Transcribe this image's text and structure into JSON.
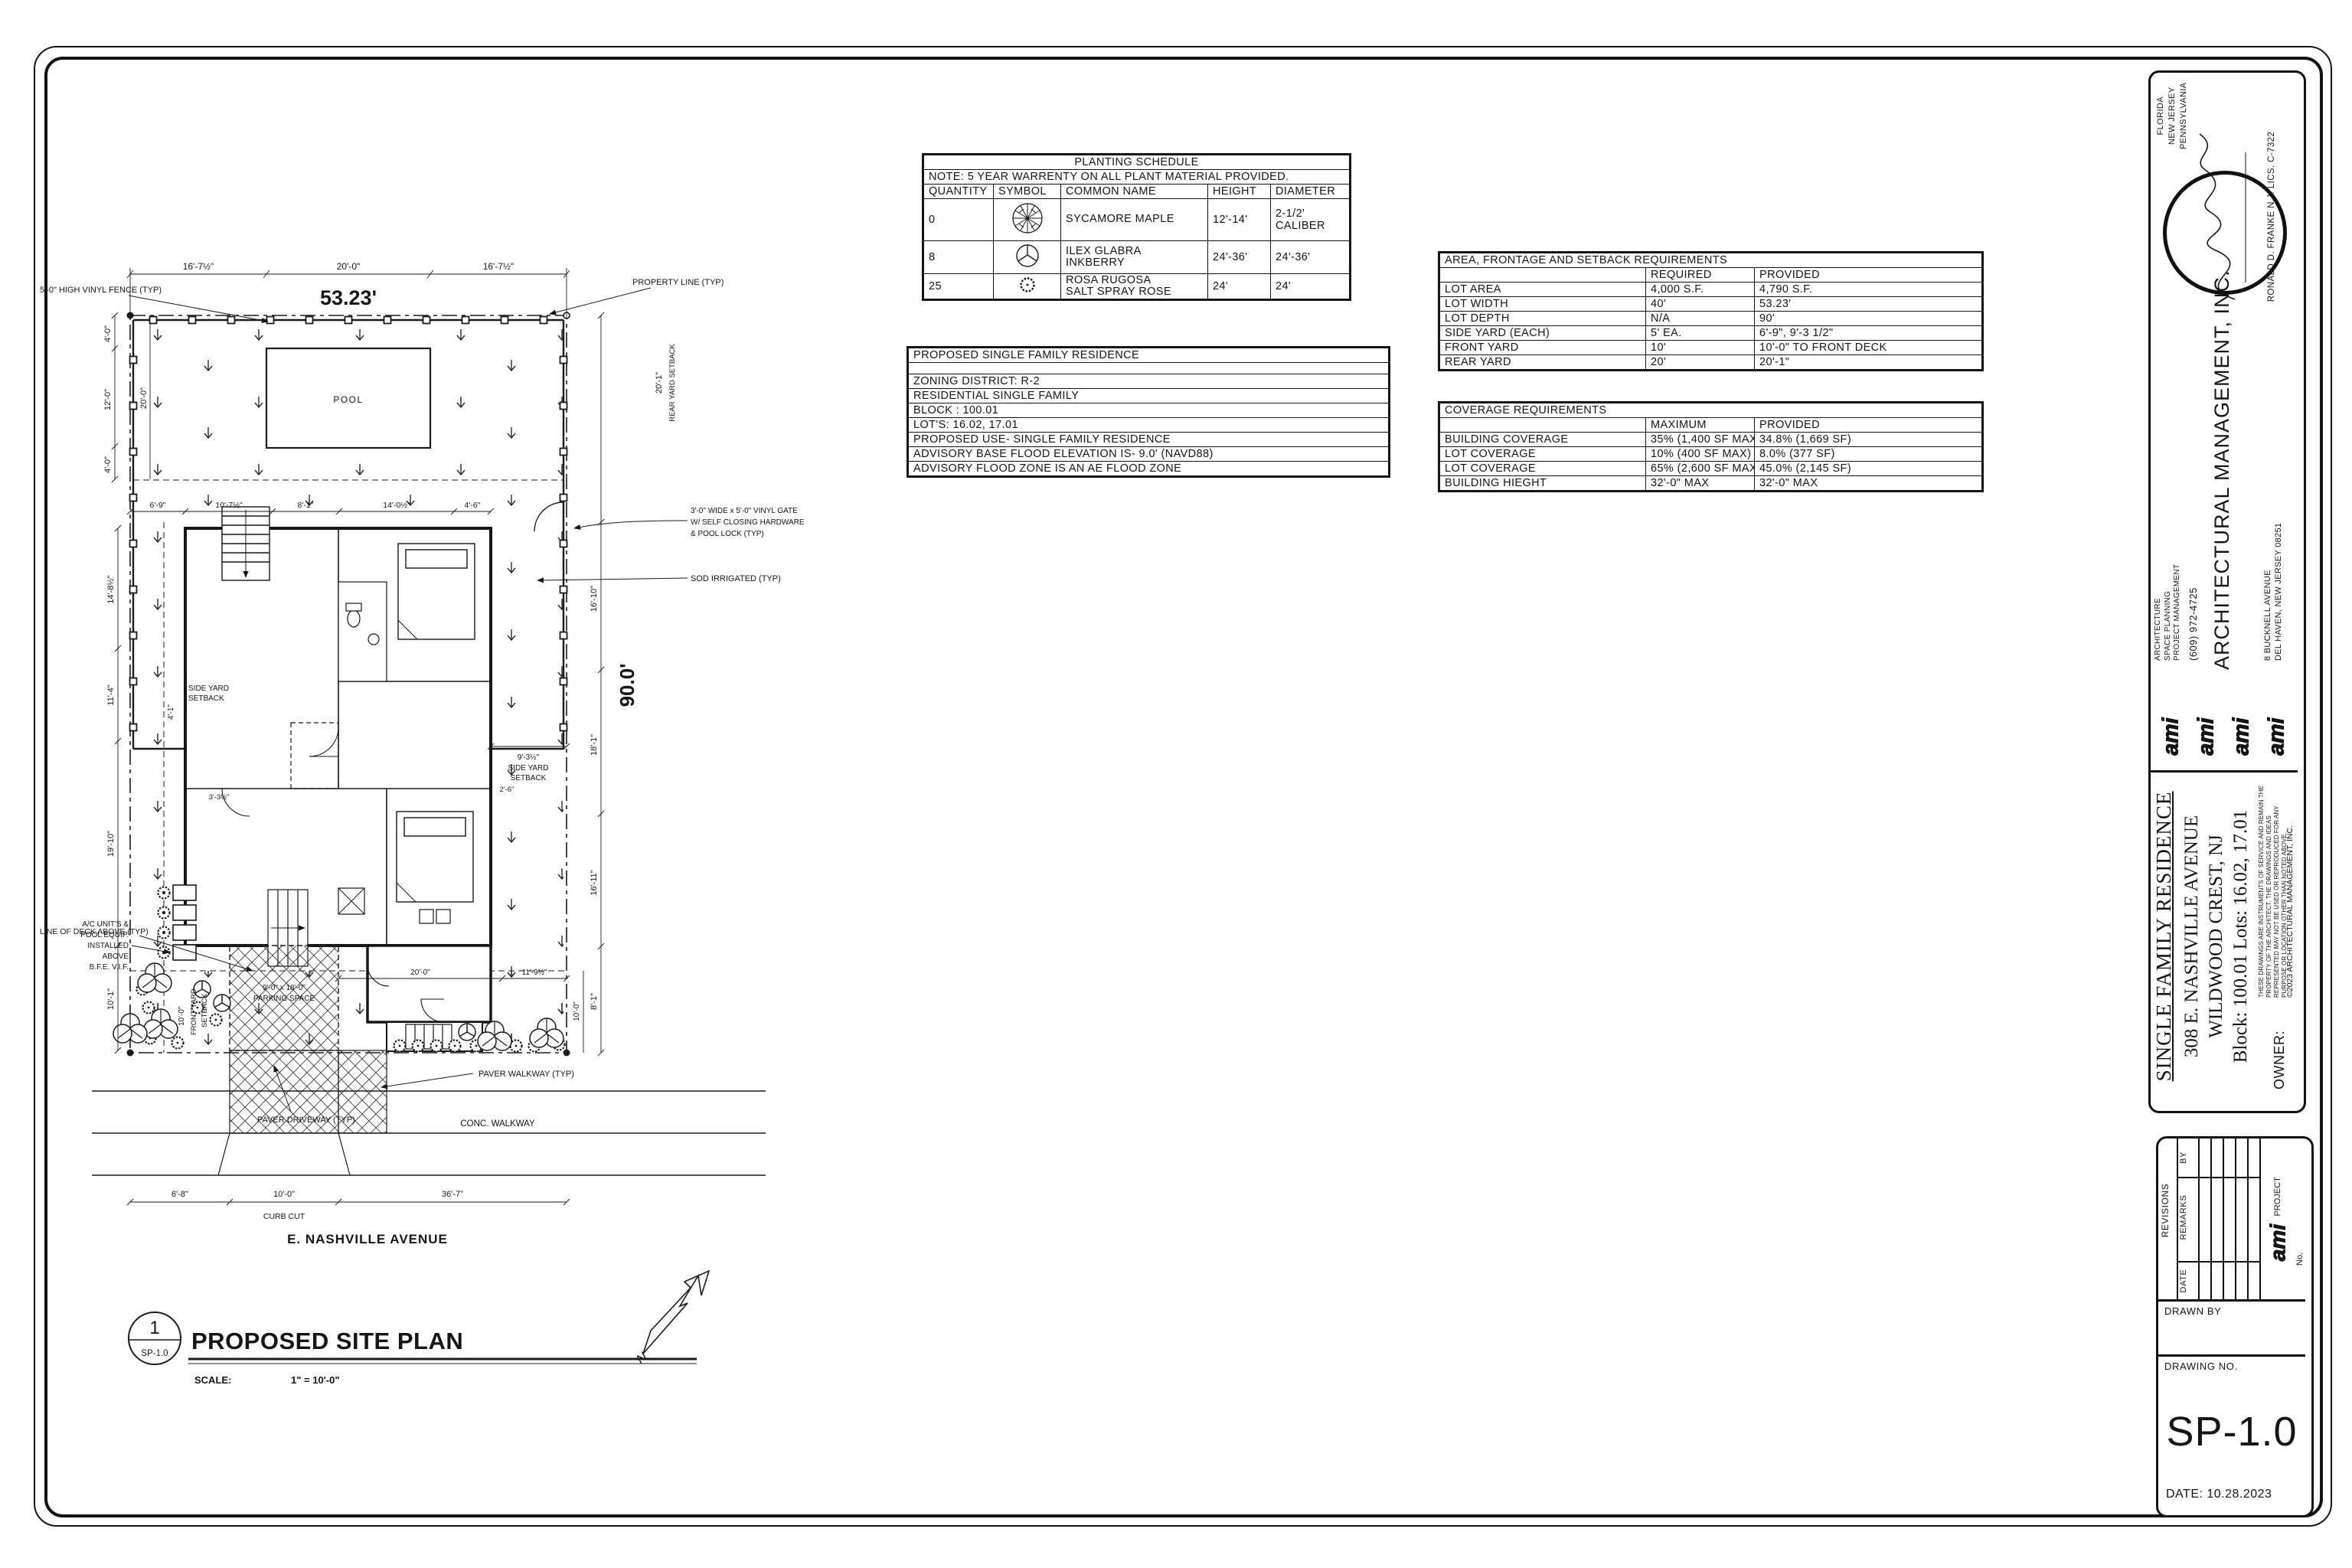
{
  "sheet_id": "SP-1.0",
  "planting_schedule": {
    "title": "PLANTING SCHEDULE",
    "note": "NOTE: 5 YEAR WARRENTY ON ALL PLANT MATERIAL PROVIDED.",
    "headers": [
      "QUANTITY",
      "SYMBOL",
      "COMMON NAME",
      "HEIGHT",
      "DIAMETER"
    ],
    "rows": [
      {
        "quantity": "0",
        "symbol": "sycamore-maple-symbol",
        "name": [
          "SYCAMORE MAPLE",
          ""
        ],
        "height": "12'-14'",
        "diameter": "2-1/2' CALIBER"
      },
      {
        "quantity": "8",
        "symbol": "inkberry-symbol",
        "name": [
          "ILEX GLABRA",
          "INKBERRY"
        ],
        "height": "24'-36'",
        "diameter": "24'-36'"
      },
      {
        "quantity": "25",
        "symbol": "salt-spray-rose-symbol",
        "name": [
          "ROSA RUGOSA",
          "SALT SPRAY ROSE"
        ],
        "height": "24'",
        "diameter": "24'"
      }
    ]
  },
  "residence_table": {
    "title": "PROPOSED SINGLE FAMILY RESIDENCE",
    "rows": [
      "ZONING DISTRICT: R-2",
      "RESIDENTIAL SINGLE FAMILY",
      "BLOCK : 100.01",
      "LOT'S: 16.02, 17.01",
      "PROPOSED USE- SINGLE FAMILY RESIDENCE",
      "ADVISORY BASE FLOOD ELEVATION IS- 9.0' (NAVD88)",
      "ADVISORY FLOOD ZONE IS AN AE FLOOD ZONE"
    ]
  },
  "area_table": {
    "title": "AREA, FRONTAGE AND SETBACK REQUIREMENTS",
    "col_required": "REQUIRED",
    "col_provided": "PROVIDED",
    "rows": [
      {
        "label": "LOT AREA",
        "required": "4,000 S.F.",
        "provided": "4,790 S.F."
      },
      {
        "label": "LOT WIDTH",
        "required": "40'",
        "provided": "53.23'"
      },
      {
        "label": "LOT DEPTH",
        "required": "N/A",
        "provided": "90'"
      },
      {
        "label": "SIDE YARD (EACH)",
        "required": "5' EA.",
        "provided": "6'-9\", 9'-3 1/2\""
      },
      {
        "label": "FRONT YARD",
        "required": "10'",
        "provided": "10'-0\" TO FRONT DECK"
      },
      {
        "label": "REAR YARD",
        "required": "20'",
        "provided": "20'-1\""
      }
    ]
  },
  "coverage_table": {
    "title": "COVERAGE REQUIREMENTS",
    "col_max": "MAXIMUM",
    "col_provided": "PROVIDED",
    "rows": [
      {
        "label": "BUILDING COVERAGE",
        "max": "35%  (1,400 SF MAX)",
        "provided": "34.8%  (1,669 SF)"
      },
      {
        "label": "LOT COVERAGE",
        "max": "10%  (400 SF MAX)",
        "provided": "8.0%  (377 SF)"
      },
      {
        "label": "LOT COVERAGE",
        "max": "65%  (2,600 SF MAX)",
        "provided": "45.0%  (2,145 SF)"
      },
      {
        "label": "BUILDING HIEGHT",
        "max": "32'-0\" MAX",
        "provided": "32'-0\" MAX"
      }
    ]
  },
  "site_plan": {
    "labels": {
      "fence": "5'-0\" HIGH VINYL FENCE (TYP)",
      "property": "PROPERTY LINE (TYP)",
      "gate1": "3'-0\" WIDE x 5'-0\" VINYL GATE",
      "gate2": "W/ SELF CLOSING HARDWARE",
      "gate3": "& POOL LOCK (TYP)",
      "sod": "SOD IRRIGATED (TYP)",
      "ac1": "A/C UNIT'S &",
      "ac2": "POOL EQUIP.",
      "ac3": "INSTALLED",
      "ac4": "ABOVE",
      "ac5": "B.F.E. V.I.F.",
      "deck": "LINE OF DECK ABOVE (TYP)",
      "park1": "9'-0\" x 18'-0\"",
      "park2": "PARKING SPACE",
      "drive": "PAVER DRIVEWAY (TYP)",
      "walk": "PAVER WALKWAY (TYP)",
      "conc": "CONC. WALKWAY",
      "street": "E. NASHVILLE AVENUE",
      "pool": "POOL"
    },
    "dims": {
      "top1": "16'-7½\"",
      "top2": "20'-0\"",
      "top3": "16'-7½\"",
      "lot_width": "53.23'",
      "left4a": "4'-0\"",
      "left12": "12'-0\"",
      "left4b": "4'-0\"",
      "left20": "20'-0\"",
      "row2_1": "6'-9\"",
      "row2_2": "10'-7½\"",
      "row2_3": "8'-1\"",
      "row2_4": "14'-0½\"",
      "row2_5": "4'-6\"",
      "v14": "14'-8½\"",
      "v11": "11'-4\"",
      "v3": "3'-3½\"",
      "v19": "19'-10\"",
      "v10": "10'-1\"",
      "r16": "16'-10\"",
      "r18": "18'-1\"",
      "r16b": "16'-11\"",
      "r8": "8'-1\"",
      "r10": "10'-0\"",
      "depth": "90.0'",
      "rear": "20'-1\"",
      "rear_label": "REAR YARD SETBACK",
      "sideL": "4'-1\"",
      "side_label1": "SIDE YARD",
      "side_label2": "SETBACK",
      "sideR": "9'-3½\"",
      "front_label1": "FRONT YARD",
      "front_label2": "SETBACK",
      "front10": "10'-0\"",
      "f20": "20'-0\"",
      "f11": "11'-9½\"",
      "b1": "6'-8\"",
      "b2": "10'-0\"",
      "b3": "36'-7\"",
      "curb": "CURB CUT",
      "c26": "2'-6\""
    },
    "title_bar": {
      "num": "1",
      "sheet": "SP-1.0",
      "name": "PROPOSED SITE PLAN",
      "scale_label": "SCALE:",
      "scale_value": "1\" = 10'-0\"",
      "north": "N"
    }
  },
  "titleblock": {
    "states": [
      "FLORIDA",
      "NEW JERSEY",
      "PENNSYLVANIA"
    ],
    "license": "RONALD D. FRANKE N.J. LICS. C-7322",
    "services": [
      "ARCHITECTURE",
      "SPACE PLANNING",
      "PROJECT MANAGEMENT"
    ],
    "phone": "(609) 972-4725",
    "firm": "ARCHITECTURAL MANAGEMENT, INC.",
    "address1": "8 BUCKNELL AVENUE",
    "address2": "DEL HAVEN, NEW JERSEY 08251",
    "logo": "ami",
    "project_title": "SINGLE FAMILY RESIDENCE",
    "project_addr1": "308 E. NASHVILLE AVENUE",
    "project_addr2": "WILDWOOD CREST, NJ",
    "project_addr3": "Block: 100.01 Lots: 16.02, 17.01",
    "owner_label": "OWNER:",
    "disclaimer": "THESE DRAWINGS ARE INSTRUMENTS OF SERVICE AND REMAIN THE PROPERTY OF THE ARCHITECT. THE DRAWINGS AND IDEAS REPRESENTED MAY NOT BE USED OR REPRODUCED FOR ANY PURPOSE OR LOCATION OTHER THAN NOTED ABOVE.",
    "copyright": "©2023 ARCHITECTURAL MANAGEMENT, INC."
  },
  "revision_block": {
    "revisions": "REVISIONS",
    "by": "BY",
    "remarks": "REMARKS",
    "date_col": "DATE",
    "project_no": "PROJECT No.",
    "drawn_by": "DRAWN BY",
    "drawing_no": "DRAWING NO.",
    "sheet": "SP-1.0",
    "date": "DATE: 10.28.2023"
  }
}
